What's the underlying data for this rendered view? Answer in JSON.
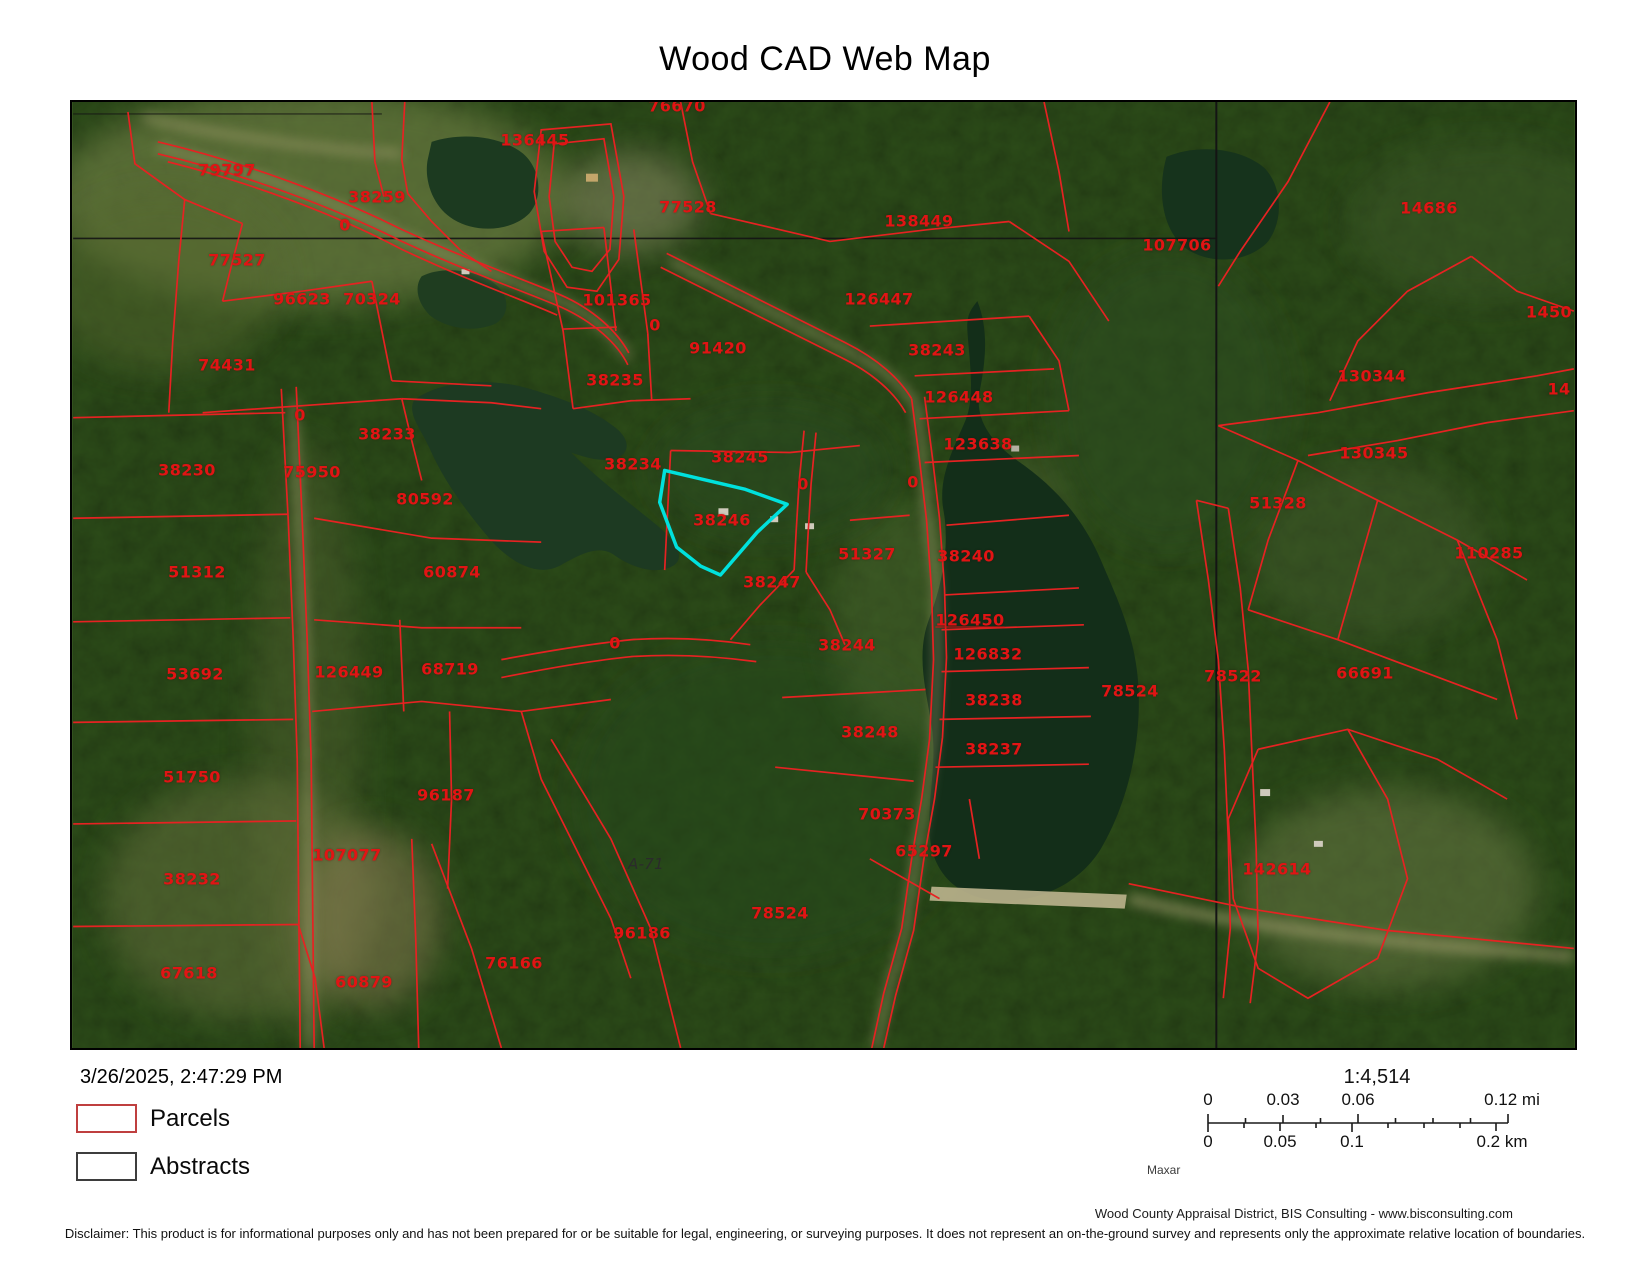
{
  "title": "Wood CAD Web Map",
  "map": {
    "highlighted_parcel": "38246",
    "labels": [
      {
        "t": "136445",
        "x": 463,
        "y": 38
      },
      {
        "t": "76670",
        "x": 605,
        "y": 4
      },
      {
        "t": "79797",
        "x": 155,
        "y": 68
      },
      {
        "t": "38259",
        "x": 305,
        "y": 95
      },
      {
        "t": "0",
        "x": 273,
        "y": 123
      },
      {
        "t": "77528",
        "x": 616,
        "y": 105
      },
      {
        "t": "138449",
        "x": 847,
        "y": 119
      },
      {
        "t": "107706",
        "x": 1105,
        "y": 143
      },
      {
        "t": "14686",
        "x": 1357,
        "y": 106
      },
      {
        "t": "77527",
        "x": 165,
        "y": 158
      },
      {
        "t": "96623",
        "x": 230,
        "y": 197
      },
      {
        "t": "70324",
        "x": 300,
        "y": 197
      },
      {
        "t": "101365",
        "x": 545,
        "y": 198
      },
      {
        "t": "1450",
        "x": 1477,
        "y": 210
      },
      {
        "t": "74431",
        "x": 155,
        "y": 263
      },
      {
        "t": "0",
        "x": 583,
        "y": 223
      },
      {
        "t": "91420",
        "x": 646,
        "y": 246
      },
      {
        "t": "126447",
        "x": 807,
        "y": 197
      },
      {
        "t": "38243",
        "x": 865,
        "y": 248
      },
      {
        "t": "130344",
        "x": 1300,
        "y": 274
      },
      {
        "t": "38235",
        "x": 543,
        "y": 278
      },
      {
        "t": "126448",
        "x": 887,
        "y": 295
      },
      {
        "t": "14",
        "x": 1487,
        "y": 287
      },
      {
        "t": "0",
        "x": 228,
        "y": 313
      },
      {
        "t": "38233",
        "x": 315,
        "y": 332
      },
      {
        "t": "123638",
        "x": 906,
        "y": 342
      },
      {
        "t": "38230",
        "x": 115,
        "y": 368
      },
      {
        "t": "75950",
        "x": 240,
        "y": 370
      },
      {
        "t": "38234",
        "x": 561,
        "y": 362
      },
      {
        "t": "38245",
        "x": 668,
        "y": 355
      },
      {
        "t": "0",
        "x": 731,
        "y": 382
      },
      {
        "t": "0",
        "x": 841,
        "y": 380
      },
      {
        "t": "130345",
        "x": 1302,
        "y": 351
      },
      {
        "t": "80592",
        "x": 353,
        "y": 397
      },
      {
        "t": "38246",
        "x": 650,
        "y": 418
      },
      {
        "t": "51328",
        "x": 1206,
        "y": 401
      },
      {
        "t": "51312",
        "x": 125,
        "y": 470
      },
      {
        "t": "60874",
        "x": 380,
        "y": 470
      },
      {
        "t": "51327",
        "x": 795,
        "y": 452
      },
      {
        "t": "38240",
        "x": 894,
        "y": 454
      },
      {
        "t": "110285",
        "x": 1417,
        "y": 451
      },
      {
        "t": "38247",
        "x": 700,
        "y": 480
      },
      {
        "t": "126450",
        "x": 898,
        "y": 518,
        "c": "u"
      },
      {
        "t": "53692",
        "x": 123,
        "y": 572
      },
      {
        "t": "126449",
        "x": 277,
        "y": 570
      },
      {
        "t": "68719",
        "x": 378,
        "y": 567
      },
      {
        "t": "38244",
        "x": 775,
        "y": 543
      },
      {
        "t": "126832",
        "x": 916,
        "y": 552
      },
      {
        "t": "0",
        "x": 543,
        "y": 541
      },
      {
        "t": "66691",
        "x": 1293,
        "y": 571
      },
      {
        "t": "38238",
        "x": 922,
        "y": 598
      },
      {
        "t": "78524",
        "x": 1058,
        "y": 589
      },
      {
        "t": "78522",
        "x": 1161,
        "y": 574
      },
      {
        "t": "51750",
        "x": 120,
        "y": 675
      },
      {
        "t": "38248",
        "x": 798,
        "y": 630
      },
      {
        "t": "38237",
        "x": 922,
        "y": 647
      },
      {
        "t": "96187",
        "x": 374,
        "y": 693
      },
      {
        "t": "70373",
        "x": 815,
        "y": 712
      },
      {
        "t": "107077",
        "x": 275,
        "y": 753
      },
      {
        "t": "65297",
        "x": 852,
        "y": 749
      },
      {
        "t": "38232",
        "x": 120,
        "y": 777
      },
      {
        "t": "A-71",
        "x": 574,
        "y": 762,
        "c": "dark"
      },
      {
        "t": "142614",
        "x": 1205,
        "y": 767
      },
      {
        "t": "78524",
        "x": 708,
        "y": 811
      },
      {
        "t": "96186",
        "x": 570,
        "y": 831
      },
      {
        "t": "76166",
        "x": 442,
        "y": 861
      },
      {
        "t": "67618",
        "x": 117,
        "y": 871
      },
      {
        "t": "60879",
        "x": 292,
        "y": 880
      }
    ]
  },
  "footer": {
    "timestamp": "3/26/2025, 2:47:29 PM",
    "legend": {
      "parcels_label": "Parcels",
      "abstracts_label": "Abstracts"
    },
    "scale": {
      "ratio": "1:4,514",
      "mi_labels": [
        "0",
        "0.03",
        "0.06",
        "0.12 mi"
      ],
      "km_labels": [
        "0",
        "0.05",
        "0.1",
        "0.2 km"
      ]
    },
    "imagery_credit": "Maxar",
    "attribution": "Wood County Appraisal District, BIS Consulting - www.bisconsulting.com",
    "disclaimer": "Disclaimer: This product is for informational purposes only and has not been prepared for or be suitable for legal, engineering, or surveying purposes. It does not represent an on-the-ground survey and represents only the approximate relative location of boundaries."
  },
  "colors": {
    "parcel_line": "#e62222",
    "parcel_label": "#e11414",
    "highlight": "#00e1dd",
    "abstract_line": "#141414",
    "water": "#16331c",
    "legend_parcel_border": "#bf3f3f",
    "legend_abstract_border": "#3d3d3d"
  }
}
